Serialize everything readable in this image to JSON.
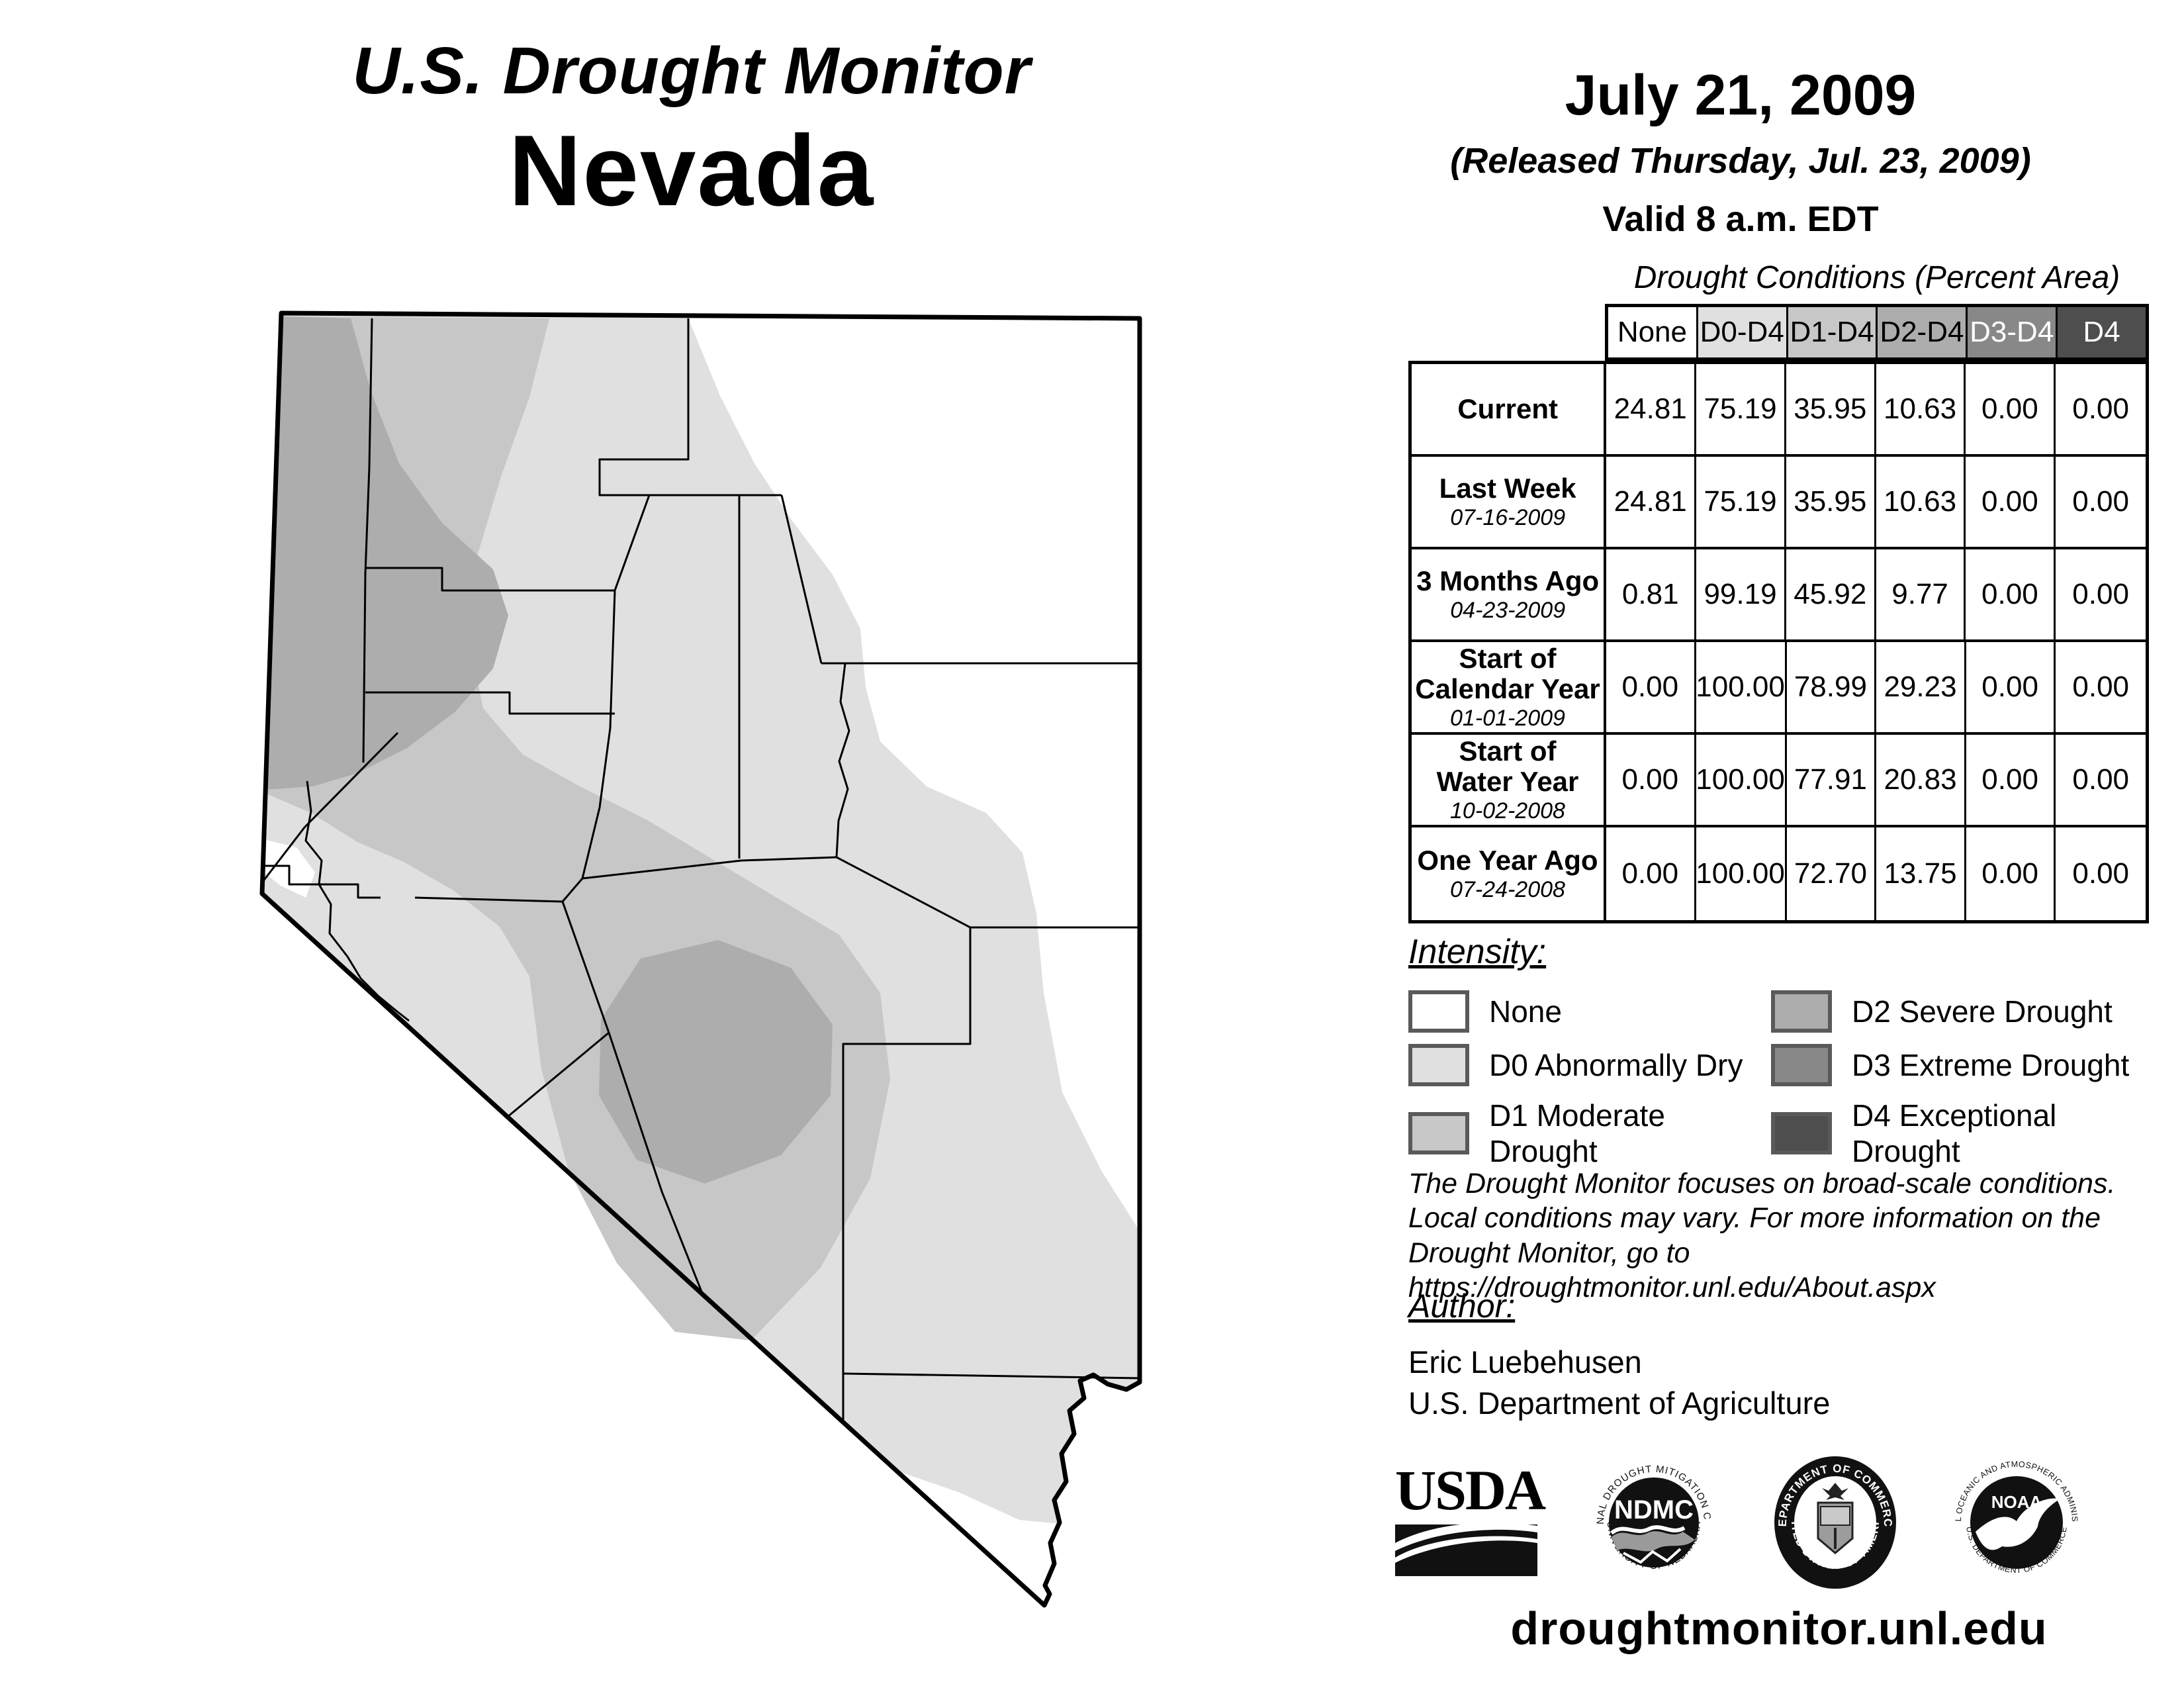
{
  "title": {
    "line1": "U.S. Drought Monitor",
    "line2": "Nevada"
  },
  "date_block": {
    "date": "July 21, 2009",
    "released": "(Released Thursday, Jul. 23, 2009)",
    "valid": "Valid 8 a.m. EDT"
  },
  "table": {
    "title": "Drought Conditions (Percent Area)",
    "columns": [
      {
        "label": "None",
        "bg": "#ffffff",
        "fg": "#000000"
      },
      {
        "label": "D0-D4",
        "bg": "#e0e0e0",
        "fg": "#000000"
      },
      {
        "label": "D1-D4",
        "bg": "#c7c7c7",
        "fg": "#000000"
      },
      {
        "label": "D2-D4",
        "bg": "#adadad",
        "fg": "#000000"
      },
      {
        "label": "D3-D4",
        "bg": "#888888",
        "fg": "#ffffff"
      },
      {
        "label": "D4",
        "bg": "#4e4e4e",
        "fg": "#ffffff"
      }
    ],
    "rows": [
      {
        "label": "Current",
        "date": "",
        "values": [
          "24.81",
          "75.19",
          "35.95",
          "10.63",
          "0.00",
          "0.00"
        ]
      },
      {
        "label": "Last Week",
        "date": "07-16-2009",
        "values": [
          "24.81",
          "75.19",
          "35.95",
          "10.63",
          "0.00",
          "0.00"
        ]
      },
      {
        "label": "3 Months Ago",
        "date": "04-23-2009",
        "values": [
          "0.81",
          "99.19",
          "45.92",
          "9.77",
          "0.00",
          "0.00"
        ]
      },
      {
        "label": "Start of\nCalendar Year",
        "date": "01-01-2009",
        "values": [
          "0.00",
          "100.00",
          "78.99",
          "29.23",
          "0.00",
          "0.00"
        ]
      },
      {
        "label": "Start of\nWater Year",
        "date": "10-02-2008",
        "values": [
          "0.00",
          "100.00",
          "77.91",
          "20.83",
          "0.00",
          "0.00"
        ]
      },
      {
        "label": "One Year Ago",
        "date": "07-24-2008",
        "values": [
          "0.00",
          "100.00",
          "72.70",
          "13.75",
          "0.00",
          "0.00"
        ]
      }
    ]
  },
  "legend": {
    "title": "Intensity:",
    "items": [
      {
        "code": "None",
        "label": "None",
        "color": "#ffffff"
      },
      {
        "code": "D0",
        "label": "D0 Abnormally Dry",
        "color": "#e0e0e0"
      },
      {
        "code": "D1",
        "label": "D1 Moderate Drought",
        "color": "#c7c7c7"
      },
      {
        "code": "D2",
        "label": "D2 Severe Drought",
        "color": "#adadad"
      },
      {
        "code": "D3",
        "label": "D3 Extreme Drought",
        "color": "#888888"
      },
      {
        "code": "D4",
        "label": "D4 Exceptional Drought",
        "color": "#4e4e4e"
      }
    ]
  },
  "disclaimer_lines": [
    "The Drought Monitor focuses on broad-scale conditions.",
    "Local conditions may vary. For more information on the",
    "Drought Monitor, go to https://droughtmonitor.unl.edu/About.aspx"
  ],
  "author": {
    "heading": "Author:",
    "name": "Eric Luebehusen",
    "org": "U.S. Department of Agriculture"
  },
  "logos": {
    "usda": {
      "text": "USDA"
    },
    "ndmc": {
      "center": "NDMC",
      "ring_top": "NATIONAL DROUGHT MITIGATION CENTER",
      "ring_bottom": "UNIVERSITY OF NEBRASKA"
    },
    "commerce": {
      "ring_top": "DEPARTMENT OF COMMERCE",
      "ring_bottom": "UNITED STATES OF AMERICA"
    },
    "noaa": {
      "center": "NOAA",
      "ring_top": "NATIONAL OCEANIC AND ATMOSPHERIC ADMINISTRATION",
      "ring_bottom": "U.S. DEPARTMENT OF COMMERCE"
    }
  },
  "footer": {
    "url": "droughtmonitor.unl.edu"
  },
  "map": {
    "state": "Nevada"
  }
}
